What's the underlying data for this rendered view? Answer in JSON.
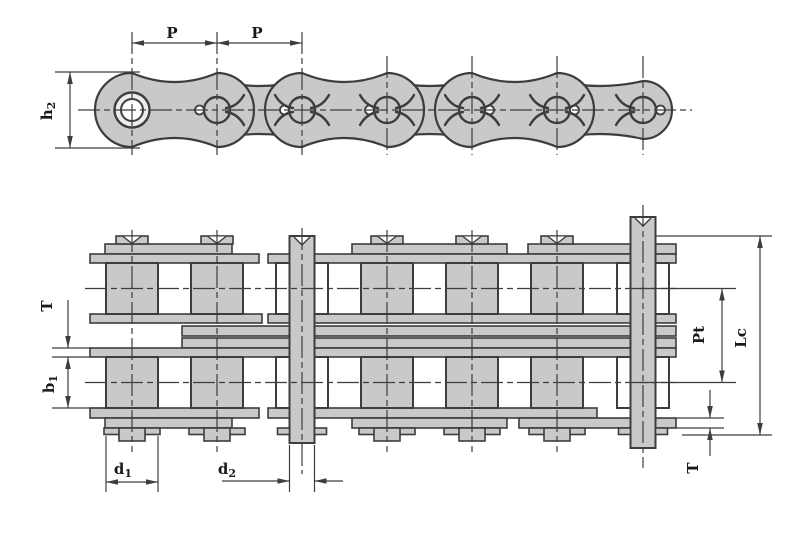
{
  "figure": {
    "type": "technical-drawing",
    "subject": "duplex roller chain — side elevation and plan section views"
  },
  "colors": {
    "background": "#ffffff",
    "line": "#3d3d3d",
    "fill": "#c9c9c9",
    "text": "#1a1a1a"
  },
  "side_view": {
    "labels": {
      "pitch_left": "P",
      "pitch_right": "P",
      "plate_height_base": "h",
      "plate_height_sub": "2"
    }
  },
  "plan_view": {
    "labels": {
      "plate_thickness_left": "T",
      "inner_width_base": "b",
      "inner_width_sub": "1",
      "roller_diameter_base": "d",
      "roller_diameter_sub": "1",
      "pin_diameter_base": "d",
      "pin_diameter_sub": "2",
      "transverse_pitch": "Pt",
      "pin_length": "Lc",
      "plate_thickness_right": "T"
    }
  }
}
